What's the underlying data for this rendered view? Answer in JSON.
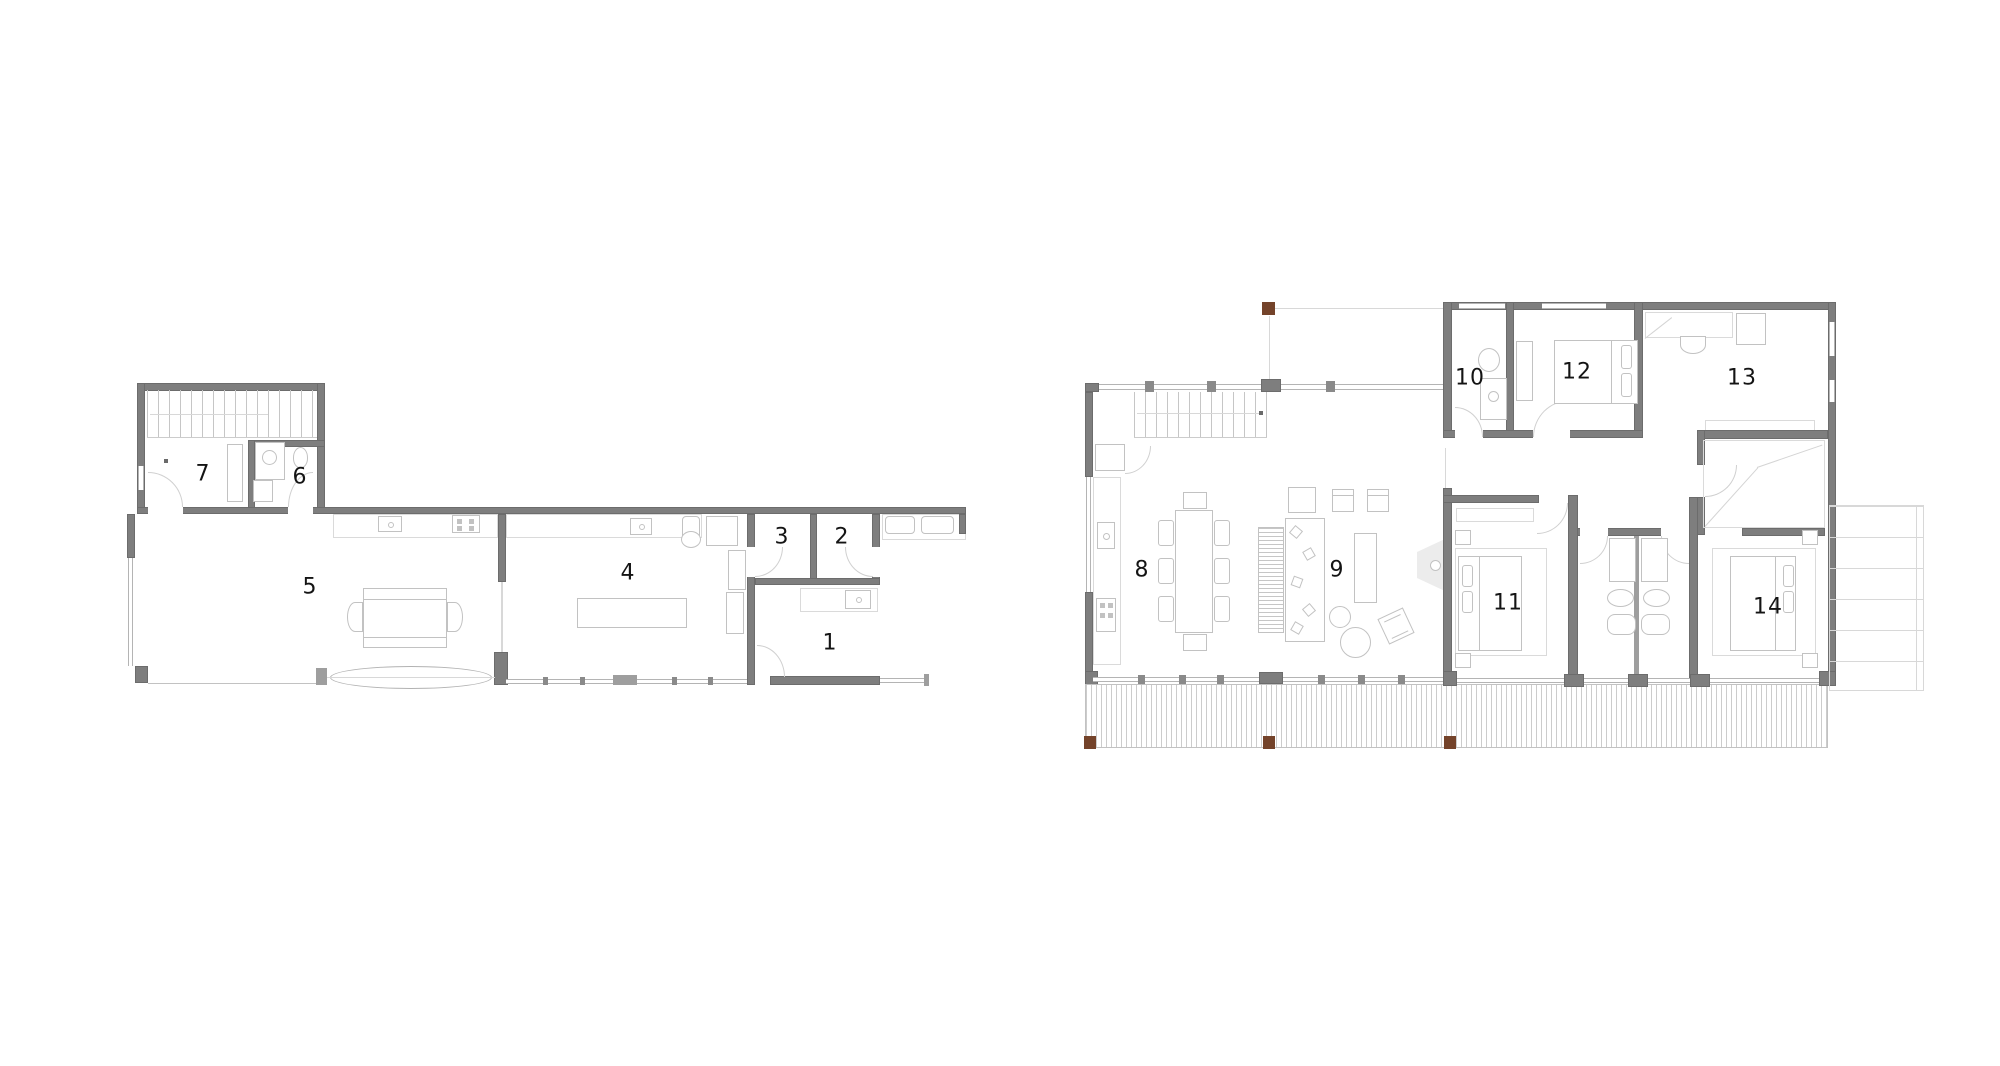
{
  "image": {
    "kind": "architectural floor plans, two levels side by side",
    "background": "#ffffff"
  },
  "colors": {
    "wall_gray": "#7e7e7e",
    "wall_edge": "#6c6c6c",
    "furniture_line": "#c2c2c2",
    "window_line": "#b4b4b4",
    "deck_line": "#cccccc",
    "post_brown": "#74432a",
    "label_black": "#141414"
  },
  "plans": {
    "left": {
      "rooms": [
        {
          "number": "1"
        },
        {
          "number": "2"
        },
        {
          "number": "3"
        },
        {
          "number": "4"
        },
        {
          "number": "5"
        },
        {
          "number": "6"
        },
        {
          "number": "7"
        }
      ]
    },
    "right": {
      "rooms": [
        {
          "number": "8"
        },
        {
          "number": "9"
        },
        {
          "number": "10"
        },
        {
          "number": "11"
        },
        {
          "number": "12"
        },
        {
          "number": "13"
        },
        {
          "number": "14"
        }
      ]
    }
  }
}
